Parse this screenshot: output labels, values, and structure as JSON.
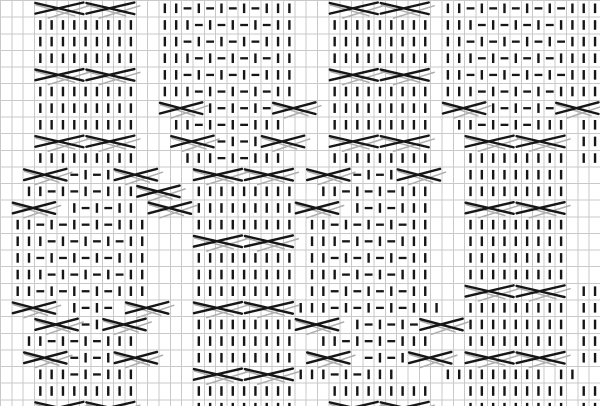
{
  "page": {
    "description": "knitting-stitch-chart on graph paper, staggered cable and seed-stitch panels, no visible text",
    "background": "#ffffff"
  },
  "chart_data": {
    "type": "knitting-chart",
    "title": "",
    "columns": 53,
    "rows": 25,
    "cell_width": 11.321,
    "cell_height": 16.64,
    "grid_on": true,
    "colors": {
      "background": "#ffffff",
      "grid_line": "#c9c9c9",
      "symbol": "#161616",
      "cable_shadow": "#aeaeae"
    },
    "legend": {
      "k": "knit-stitch-vertical-bar",
      "p": "purl-stitch-horizontal-dash",
      ".": "empty-cell",
      "crossing": "cable-cross-X-symbol spanning several columns"
    },
    "cells": [
      "..............kkpkpkpkpkkk.............kkpkpkpkpkpkkk",
      "...kkkkkkkkk..kkkpkpkpkpkk...kkkkkkkkk.kkkpkpkpkpkkkk",
      "...kkkkkkkkk..kkpkpkpkpkkk...kkkkkkkkk.kkpkpkpkpkpkkk",
      "...kkkkkkkkk..kkkpkpkpkpkk...kkkkkkkkk.kkkpkpkpkpkkkk",
      "..............kkpkpkpkpkkk.............kkpkpkpkpkpkkk",
      "...kkkkkkkkk..kkkpkpkpkpkk...kkkkkkkkk.kkkpkpkpkpkkkk",
      "...kkkkkkkkk......kpkpkp.....kkkkkkkkk.....kpkpkp....",
      "...kkkkkkkkk...kkpkpkpkkk....kkkkkkkkk..kkpkpkpkkk.kk",
      "...................pkpk............................kk",
      "...kkkkkkkkk....kkkpkpkkk....kkkkkkkkk...kkkkkkkkk.kk",
      "......pkpk.....................pkpk......kkkkkkkkk...",
      "..kkpkpkpkkk.....kkkkkkkkk..kkpkpkpkkk...kkkkkkkkk...",
      "......kpkpkk.....kkkkkkkkk.....kpkpkkk...............",
      ".kkpkpkpkpkkk....kkkkkkkkk.kkpkpkpkpkk...kkkkkkkkk...",
      ".kkkpkpkpkpkk..............kkkpkpkpkkk...kkkkkkkkk...",
      ".kkpkpkpkpkkk....kkkkkkkkk.kkpkpkpkpkk...kkkkkkkkk...",
      ".kkkpkpkpkpkk....kkkkkkkkk.kkkpkpkpkkk...kkkkkkkkk...",
      ".kkpkpkpkpkkk....kkkkkkkkk.kkpkpkpkpkk.............kk",
      "......kpkp................kkkpkpkpkpkkk..kkkkkkkkk.kk",
      ".......pk........kkkkkkkkk.....kpkpkp....kkkkkkkkk.kk",
      "..kkpkpkpkkk.....kkkkkkkkk..kkpkpkpkkk...kkkkkkkkk.kk",
      "......pkpk.......kkkkkkkkk......pkpk...............kk",
      "...kkkpkpkkk..............kkkpkpkkk....kkkkkkkkk.kk..",
      "...kkkkkkkkk.....kkkkkkkkk...kkkkkkkkk...kkkkkkkkk.kk",
      ".................kkkkkkkkk...............kkkkkkkkk.kk"
    ],
    "crossings": [
      [
        0,
        3,
        7.5
      ],
      [
        0,
        7.5,
        12
      ],
      [
        0,
        29,
        33.5
      ],
      [
        0,
        33.5,
        38
      ],
      [
        4,
        3,
        7.5
      ],
      [
        4,
        7.5,
        12
      ],
      [
        4,
        29,
        33.5
      ],
      [
        4,
        33.5,
        38
      ],
      [
        6,
        14,
        18
      ],
      [
        6,
        24,
        28
      ],
      [
        6,
        39,
        43
      ],
      [
        6,
        49,
        53
      ],
      [
        8,
        3,
        7.5
      ],
      [
        8,
        7.5,
        12
      ],
      [
        8,
        15,
        19
      ],
      [
        8,
        23,
        27
      ],
      [
        8,
        29,
        33.5
      ],
      [
        8,
        33.5,
        38
      ],
      [
        8,
        41,
        45.5
      ],
      [
        8,
        45.5,
        50
      ],
      [
        10,
        2,
        6
      ],
      [
        10,
        10,
        14
      ],
      [
        10,
        17,
        21.5
      ],
      [
        10,
        21.5,
        26
      ],
      [
        10,
        27,
        31
      ],
      [
        10,
        35,
        39
      ],
      [
        11,
        12,
        16
      ],
      [
        12,
        1,
        5
      ],
      [
        12,
        13,
        17
      ],
      [
        12,
        26,
        30
      ],
      [
        12,
        41,
        45.5
      ],
      [
        12,
        45.5,
        50
      ],
      [
        14,
        17,
        21.5
      ],
      [
        14,
        21.5,
        26
      ],
      [
        17,
        41,
        45.5
      ],
      [
        17,
        45.5,
        50
      ],
      [
        18,
        1,
        5
      ],
      [
        18,
        11,
        15
      ],
      [
        18,
        17,
        21.5
      ],
      [
        18,
        21.5,
        26
      ],
      [
        19,
        3,
        7
      ],
      [
        19,
        9,
        13
      ],
      [
        19,
        26,
        30
      ],
      [
        19,
        37,
        41
      ],
      [
        21,
        2,
        6
      ],
      [
        21,
        10,
        14
      ],
      [
        21,
        27,
        31
      ],
      [
        21,
        36,
        40
      ],
      [
        21,
        41,
        45.5
      ],
      [
        21,
        45.5,
        50
      ],
      [
        22,
        17,
        21.5
      ],
      [
        22,
        21.5,
        26
      ],
      [
        24,
        3,
        7.5
      ],
      [
        24,
        7.5,
        12
      ],
      [
        24,
        29,
        33.5
      ],
      [
        24,
        33.5,
        38
      ]
    ]
  }
}
